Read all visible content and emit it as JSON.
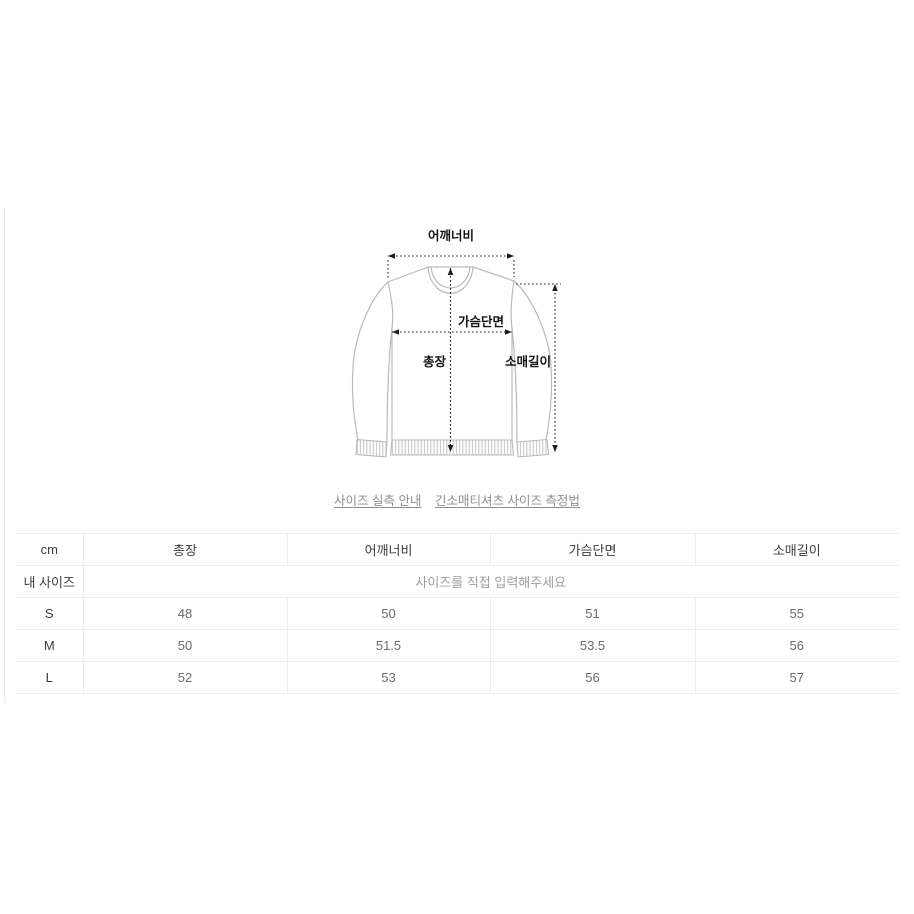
{
  "colors": {
    "garment": "#bababa",
    "measure": "#1f1f1f",
    "label": "#141414",
    "link": "#8f8f8f",
    "border": "#ededed",
    "header_text": "#3d3d3d",
    "value_text": "#6b6b6b",
    "placeholder_text": "#9e9e9e",
    "edge_line": "#ececea"
  },
  "diagram": {
    "labels": {
      "shoulder": "어깨너비",
      "chest": "가슴단면",
      "length": "총장",
      "sleeve": "소매길이"
    }
  },
  "links": [
    {
      "label": "사이즈 실측 안내"
    },
    {
      "label": "긴소매티셔츠 사이즈 측정법"
    }
  ],
  "size_table": {
    "columns": [
      "cm",
      "총장",
      "어깨너비",
      "가슴단면",
      "소매길이"
    ],
    "my_size": {
      "label": "내 사이즈",
      "placeholder": "사이즈를 직접 입력해주세요"
    },
    "rows": [
      {
        "size": "S",
        "values": [
          "48",
          "50",
          "51",
          "55"
        ]
      },
      {
        "size": "M",
        "values": [
          "50",
          "51.5",
          "53.5",
          "56"
        ]
      },
      {
        "size": "L",
        "values": [
          "52",
          "53",
          "56",
          "57"
        ]
      }
    ]
  }
}
